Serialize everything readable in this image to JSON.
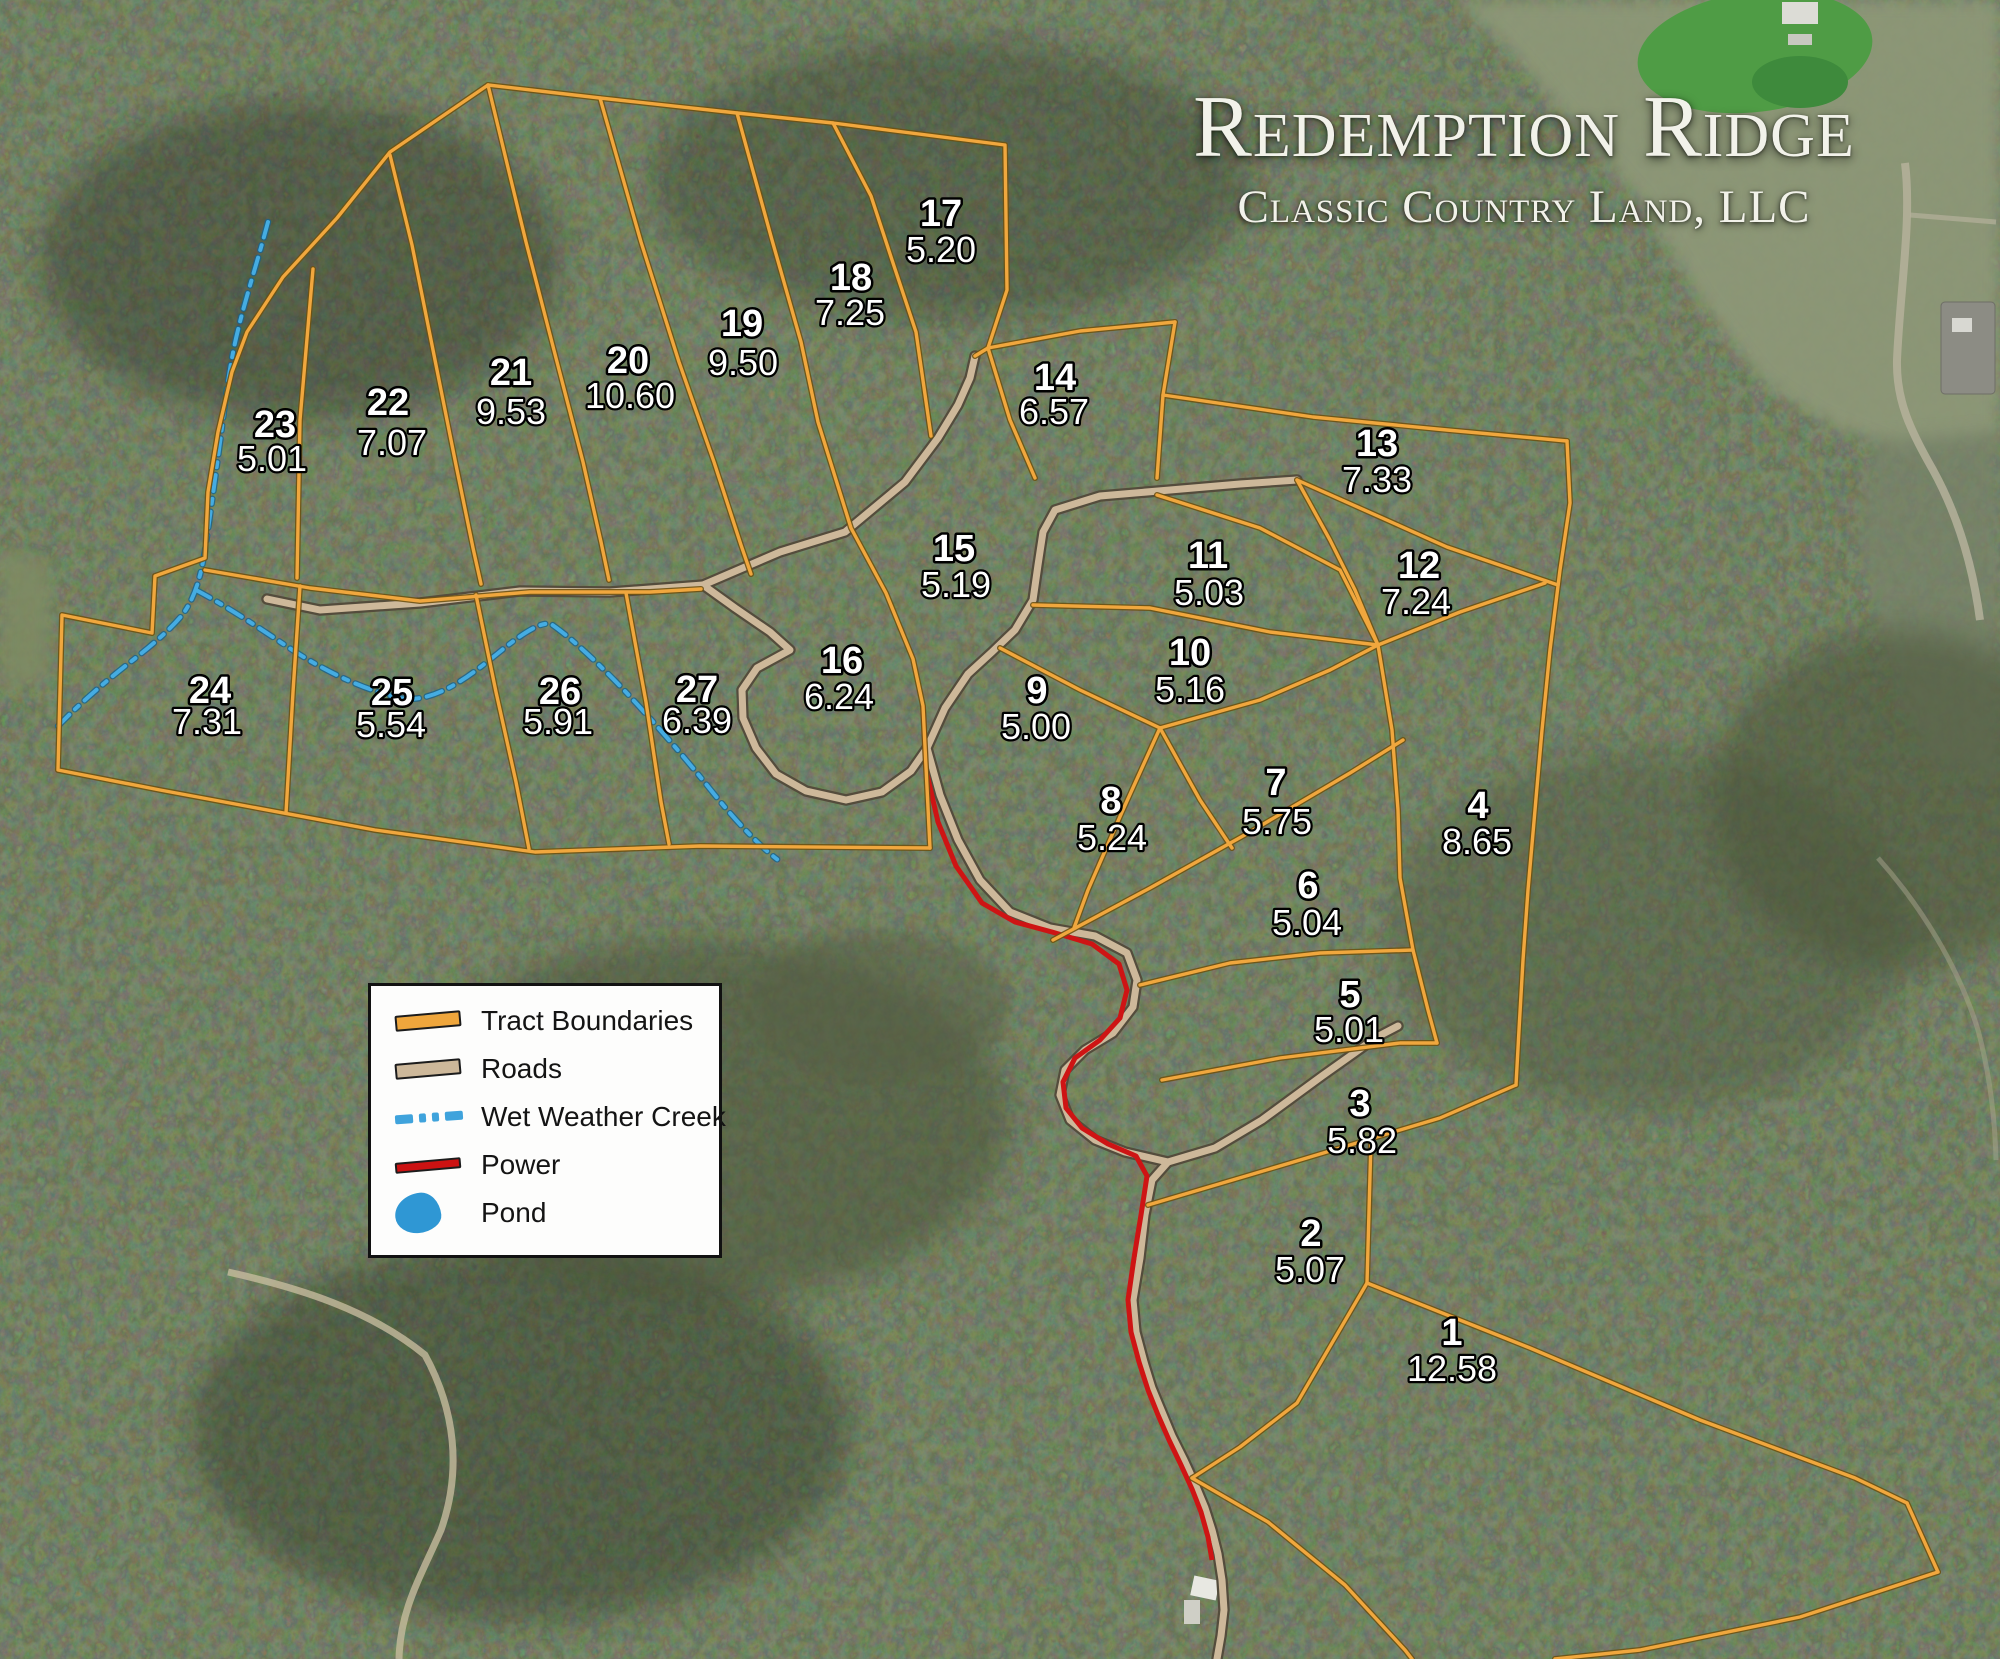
{
  "title": {
    "name": "Redemption Ridge",
    "company": "Classic Country Land, LLC"
  },
  "legend": {
    "items": [
      {
        "label": "Tract Boundaries",
        "symbol": "orange-line"
      },
      {
        "label": "Roads",
        "symbol": "tan-line"
      },
      {
        "label": "Wet Weather Creek",
        "symbol": "blue-dash-dot-line"
      },
      {
        "label": "Power",
        "symbol": "red-line"
      },
      {
        "label": "Pond",
        "symbol": "blue-blob"
      }
    ]
  },
  "tracts": [
    {
      "num": "1",
      "acres": "12.58"
    },
    {
      "num": "2",
      "acres": "5.07"
    },
    {
      "num": "3",
      "acres": "5.82"
    },
    {
      "num": "4",
      "acres": "8.65"
    },
    {
      "num": "5",
      "acres": "5.01"
    },
    {
      "num": "6",
      "acres": "5.04"
    },
    {
      "num": "7",
      "acres": "5.75"
    },
    {
      "num": "8",
      "acres": "5.24"
    },
    {
      "num": "9",
      "acres": "5.00"
    },
    {
      "num": "10",
      "acres": "5.16"
    },
    {
      "num": "11",
      "acres": "5.03"
    },
    {
      "num": "12",
      "acres": "7.24"
    },
    {
      "num": "13",
      "acres": "7.33"
    },
    {
      "num": "14",
      "acres": "6.57"
    },
    {
      "num": "15",
      "acres": "5.19"
    },
    {
      "num": "16",
      "acres": "6.24"
    },
    {
      "num": "17",
      "acres": "5.20"
    },
    {
      "num": "18",
      "acres": "7.25"
    },
    {
      "num": "19",
      "acres": "9.50"
    },
    {
      "num": "20",
      "acres": "10.60"
    },
    {
      "num": "21",
      "acres": "9.53"
    },
    {
      "num": "22",
      "acres": "7.07"
    },
    {
      "num": "23",
      "acres": "5.01"
    },
    {
      "num": "24",
      "acres": "7.31"
    },
    {
      "num": "25",
      "acres": "5.54"
    },
    {
      "num": "26",
      "acres": "5.91"
    },
    {
      "num": "27",
      "acres": "6.39"
    }
  ],
  "colors": {
    "tract_boundary": "#EFA63C",
    "road": "#CDB89A",
    "creek": "#44A8E0",
    "power": "#CC1212",
    "pond": "#2F97D4"
  }
}
